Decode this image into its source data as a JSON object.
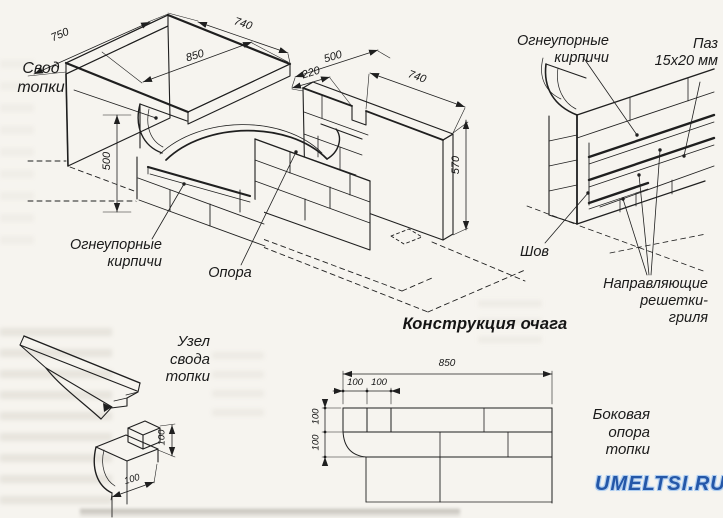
{
  "page": {
    "title": "Конструкция очага",
    "watermark": "UMELTSI.RU",
    "colors": {
      "line": "#1f1f1f",
      "paper": "#f6f4ef",
      "watermark_blue": "#2457a8",
      "watermark_glow": "#aecdf0"
    }
  },
  "main_view": {
    "labels": {
      "vault": "Свод\nтопки",
      "firebricks": "Огнеупорные\nкирпичи",
      "support": "Опора"
    },
    "dimensions": {
      "left_wall_width": "750",
      "slab_length": "740",
      "opening_depth": "850",
      "gap": "500",
      "slot_offset": "220",
      "right_wall_length": "740",
      "right_wall_height": "570",
      "opening_height": "500"
    }
  },
  "detail_view": {
    "labels": {
      "firebricks": "Огнеупорные\nкирпичи",
      "groove": "Паз\n15х20 мм",
      "seam": "Шов",
      "grill_guides": "Направляющие\nрешетки-\nгриля"
    }
  },
  "node_view": {
    "label": "Узел\nсвода\nтопки",
    "dimensions": {
      "height": "100",
      "width": "100"
    }
  },
  "plan_view": {
    "label": "Боковая\nопора\nтопки",
    "dimensions": {
      "total_length": "850",
      "top_first": "100",
      "top_second": "100",
      "left_first": "100",
      "left_second": "100"
    }
  }
}
